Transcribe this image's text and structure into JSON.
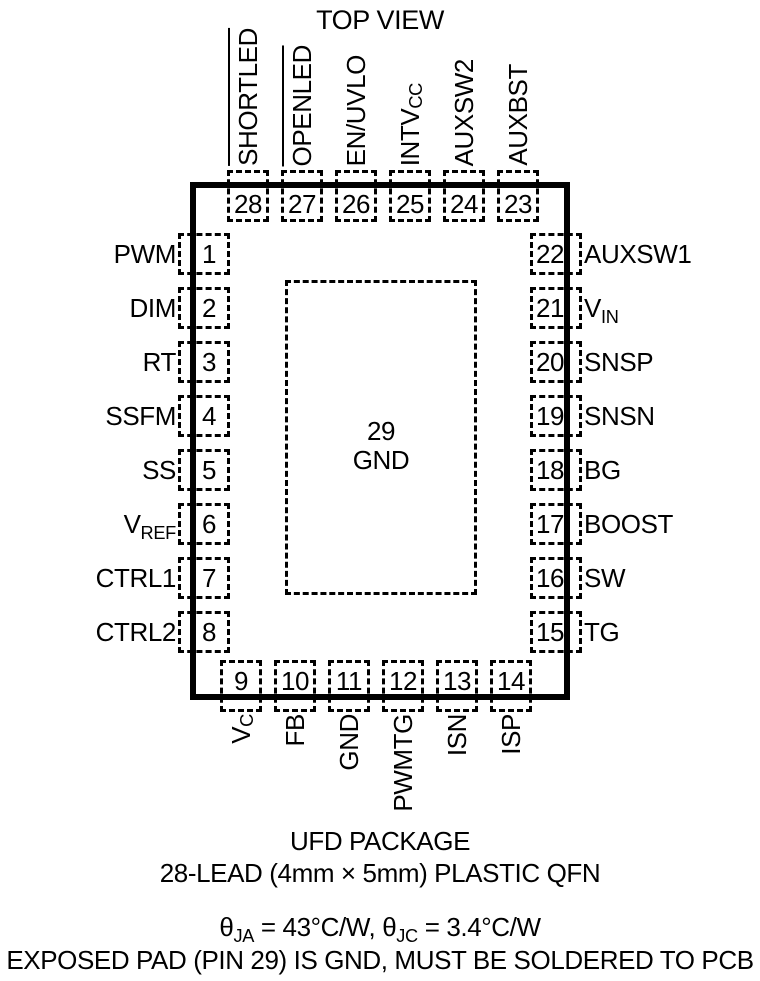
{
  "title": "TOP VIEW",
  "colors": {
    "ink": "#000000",
    "background": "#ffffff"
  },
  "package": {
    "center_pad": {
      "number": "29",
      "name": "GND"
    },
    "pins_top": [
      {
        "num": "28",
        "label": "SHORTLED",
        "overline": true
      },
      {
        "num": "27",
        "label": "OPENLED",
        "overline": true
      },
      {
        "num": "26",
        "label": "EN/UVLO"
      },
      {
        "num": "25",
        "label": "INTV",
        "sub": "CC"
      },
      {
        "num": "24",
        "label": "AUXSW2"
      },
      {
        "num": "23",
        "label": "AUXBST"
      }
    ],
    "pins_left": [
      {
        "num": "1",
        "label": "PWM"
      },
      {
        "num": "2",
        "label": "DIM"
      },
      {
        "num": "3",
        "label": "RT"
      },
      {
        "num": "4",
        "label": "SSFM"
      },
      {
        "num": "5",
        "label": "SS"
      },
      {
        "num": "6",
        "label": "V",
        "sub": "REF"
      },
      {
        "num": "7",
        "label": "CTRL1"
      },
      {
        "num": "8",
        "label": "CTRL2"
      }
    ],
    "pins_right": [
      {
        "num": "22",
        "label": "AUXSW1"
      },
      {
        "num": "21",
        "label": "V",
        "sub": "IN"
      },
      {
        "num": "20",
        "label": "SNSP"
      },
      {
        "num": "19",
        "label": "SNSN"
      },
      {
        "num": "18",
        "label": "BG"
      },
      {
        "num": "17",
        "label": "BOOST"
      },
      {
        "num": "16",
        "label": "SW"
      },
      {
        "num": "15",
        "label": "TG"
      }
    ],
    "pins_bottom": [
      {
        "num": "9",
        "label": "V",
        "sub": "C"
      },
      {
        "num": "10",
        "label": "FB"
      },
      {
        "num": "11",
        "label": "GND"
      },
      {
        "num": "12",
        "label": "PWMTG"
      },
      {
        "num": "13",
        "label": "ISN"
      },
      {
        "num": "14",
        "label": "ISP"
      }
    ]
  },
  "footer": {
    "package_name": "UFD PACKAGE",
    "package_desc": "28-LEAD (4mm × 5mm) PLASTIC QFN",
    "thermal": {
      "theta1": "θ",
      "sub1": "JA",
      "mid1": " = 43°C/W, ",
      "theta2": "θ",
      "sub2": "JC",
      "mid2": " = 3.4°C/W"
    },
    "note": "EXPOSED PAD (PIN 29) IS GND, MUST BE SOLDERED TO PCB"
  }
}
